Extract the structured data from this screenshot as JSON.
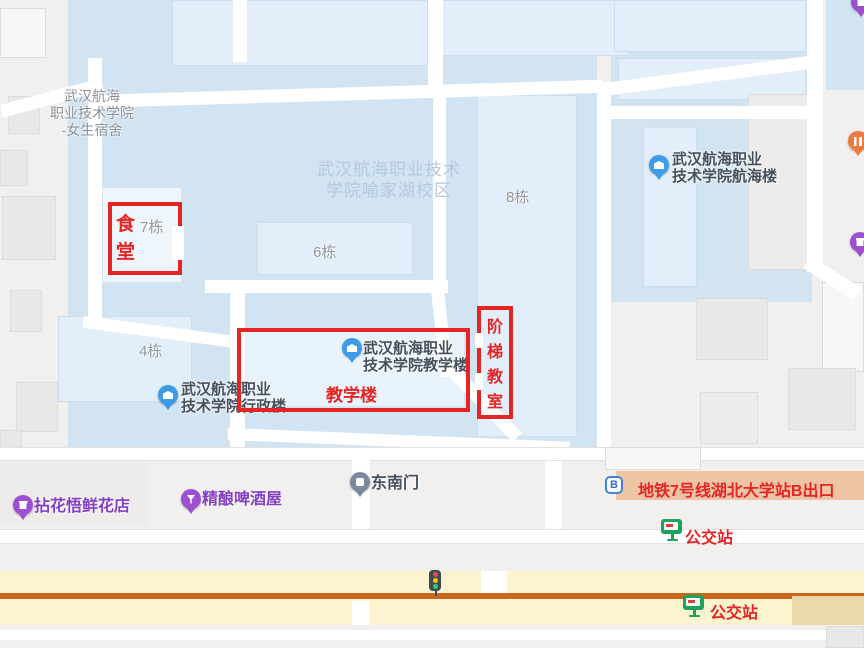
{
  "map": {
    "watermark_line1": "武汉航海职业技术",
    "watermark_line2": "学院喻家湖校区",
    "dorm_line1": "武汉航海",
    "dorm_line2": "职业技术学院",
    "dorm_line3": "-女生宿舍",
    "b4": "4栋",
    "b6": "6栋",
    "b7": "7栋",
    "b8": "8栋"
  },
  "pois": {
    "teaching_line1": "武汉航海职业",
    "teaching_line2": "技术学院教学楼",
    "admin_line1": "武汉航海职业",
    "admin_line2": "技术学院行政楼",
    "nautical_line1": "武汉航海职业",
    "nautical_line2": "技术学院航海楼",
    "gate": "东南门",
    "flower_shop": "拈花悟鲜花店",
    "beer_house": "精酿啤酒屋",
    "metro_badge": "B"
  },
  "annotations": {
    "canteen_char1": "食",
    "canteen_char2": "堂",
    "teaching_label": "教学楼",
    "lecture_c1": "阶",
    "lecture_c2": "梯",
    "lecture_c3": "教",
    "lecture_c4": "室",
    "metro_exit": "地铁7号线湖北大学站B出口",
    "bus_stop_1": "公交站",
    "bus_stop_2": "公交站"
  },
  "colors": {
    "annotation_red": "#e52525",
    "campus_blue": "#d2e4f2",
    "building_blue": "#e2eef9",
    "poi_purple": "#8440c4",
    "poi_blue": "#3e9be9",
    "bus_green": "#1fa25c",
    "metro_band_tan": "#edc5a5",
    "road_yellow": "#fcf3cf",
    "road_orange_line": "#ca671f",
    "watermark_blue": "#b4c9de"
  }
}
